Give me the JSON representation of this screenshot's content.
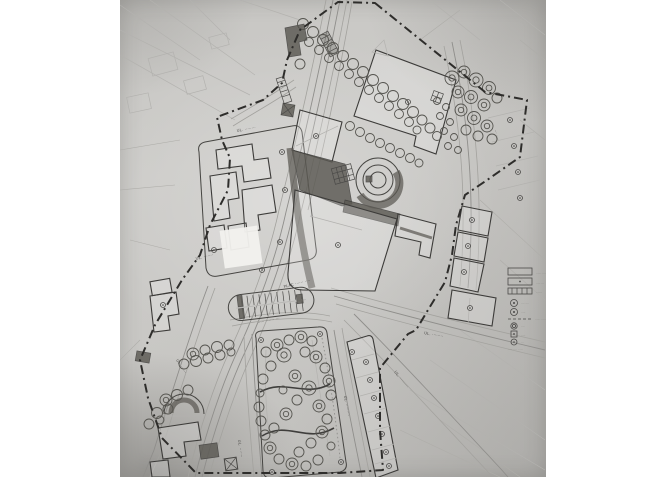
{
  "photo": {
    "description": "Black-and-white photograph of a hand-drawn urban development site plan (city centre masterplan) with dashed site boundary, streets, building footprints, a circular pavilion, parking bay, tree-lined avenue and a park",
    "paper_color": "#c9c8c5",
    "ink_color": "#3a3a38",
    "dark_fill": "#5b5953",
    "boundary_style": "dash-dot"
  },
  "map_labels": [
    {
      "id": "street-nw",
      "text": "UL. ········"
    },
    {
      "id": "street-w",
      "text": "UL. ·······"
    },
    {
      "id": "square",
      "text": "PLAC ······ ····"
    },
    {
      "id": "parking-note",
      "text": "····· ······ ···"
    },
    {
      "id": "street-e",
      "text": "UL. ········"
    },
    {
      "id": "street-se",
      "text": "UL. ·········"
    },
    {
      "id": "street-sw",
      "text": "UL. ······"
    },
    {
      "id": "street-park-w",
      "text": "UL. ·······"
    },
    {
      "id": "street-park-e",
      "text": "UL. ·········"
    },
    {
      "id": "street-ne",
      "text": "··· ····"
    }
  ],
  "legend": {
    "items": [
      {
        "symbol": "rect-outline",
        "label": "······ ·····"
      },
      {
        "symbol": "rect-dot",
        "label": "····· ···"
      },
      {
        "symbol": "rect-hatched",
        "label": "·······"
      },
      {
        "symbol": "circle-dot",
        "label": "···· ····"
      },
      {
        "symbol": "circle-dot-bold",
        "label": "·····"
      },
      {
        "symbol": "dashed-line",
        "label": "······ ·····"
      },
      {
        "symbol": "circle-ring",
        "label": "····"
      },
      {
        "symbol": "square-dot",
        "label": "·····"
      },
      {
        "symbol": "circle-small",
        "label": "···"
      }
    ],
    "caption": "····· ···· · ····"
  },
  "map_features": {
    "trees": {
      "avenue1": [
        [
          303,
          24,
          5.5
        ],
        [
          313,
          32,
          5.5
        ],
        [
          323,
          40,
          5.5
        ],
        [
          333,
          48,
          5.5
        ],
        [
          343,
          56,
          5.5
        ],
        [
          353,
          64,
          5.5
        ],
        [
          363,
          72,
          5.5
        ],
        [
          373,
          80,
          5.5
        ],
        [
          383,
          88,
          5.5
        ],
        [
          393,
          96,
          5.5
        ],
        [
          403,
          104,
          5.5
        ],
        [
          413,
          112,
          5.5
        ],
        [
          422,
          120,
          5
        ],
        [
          430,
          128,
          5
        ],
        [
          437,
          136,
          4.5
        ]
      ],
      "avenue2": [
        [
          309,
          42,
          4.5
        ],
        [
          319,
          50,
          4.5
        ],
        [
          329,
          58,
          4.5
        ],
        [
          339,
          66,
          4.5
        ],
        [
          349,
          74,
          4.5
        ],
        [
          359,
          82,
          4.5
        ],
        [
          369,
          90,
          4.5
        ],
        [
          379,
          98,
          4.5
        ],
        [
          389,
          106,
          4.5
        ],
        [
          399,
          114,
          4.5
        ],
        [
          409,
          122,
          4.5
        ],
        [
          417,
          130,
          4
        ]
      ],
      "plazarow": [
        [
          350,
          126,
          4.5
        ],
        [
          360,
          132,
          4.5
        ],
        [
          370,
          138,
          4.5
        ],
        [
          380,
          143,
          4.5
        ],
        [
          390,
          148,
          4.5
        ],
        [
          400,
          153,
          4.5
        ],
        [
          410,
          158,
          4.5
        ],
        [
          419,
          163,
          4
        ]
      ],
      "negrove": [
        [
          452,
          78,
          7
        ],
        [
          464,
          72,
          6
        ],
        [
          476,
          80,
          7
        ],
        [
          489,
          88,
          6.5
        ],
        [
          458,
          92,
          6
        ],
        [
          471,
          97,
          6.5
        ],
        [
          484,
          105,
          6
        ],
        [
          461,
          110,
          6
        ],
        [
          474,
          118,
          6.5
        ],
        [
          487,
          126,
          6
        ],
        [
          466,
          130,
          5
        ],
        [
          497,
          98,
          5
        ],
        [
          492,
          139,
          5
        ],
        [
          478,
          136,
          5
        ]
      ],
      "courtyard": [
        [
          437,
          101,
          3.5
        ],
        [
          446,
          107,
          3.5
        ],
        [
          440,
          116,
          3.5
        ],
        [
          450,
          122,
          3.5
        ],
        [
          444,
          131,
          3.5
        ],
        [
          454,
          137,
          3.5
        ],
        [
          448,
          146,
          3.5
        ],
        [
          458,
          150,
          3.5
        ]
      ],
      "park": [
        [
          266,
          352,
          5
        ],
        [
          277,
          345,
          6
        ],
        [
          289,
          340,
          5
        ],
        [
          301,
          337,
          6
        ],
        [
          312,
          341,
          5
        ],
        [
          284,
          355,
          7
        ],
        [
          271,
          366,
          5
        ],
        [
          263,
          379,
          5
        ],
        [
          260,
          393,
          4
        ],
        [
          259,
          407,
          5
        ],
        [
          261,
          421,
          5
        ],
        [
          265,
          435,
          5
        ],
        [
          270,
          448,
          6
        ],
        [
          279,
          459,
          5
        ],
        [
          292,
          464,
          6
        ],
        [
          306,
          466,
          5
        ],
        [
          318,
          460,
          5
        ],
        [
          305,
          352,
          5
        ],
        [
          316,
          357,
          6
        ],
        [
          325,
          368,
          5
        ],
        [
          329,
          381,
          6
        ],
        [
          331,
          395,
          5
        ],
        [
          309,
          388,
          7
        ],
        [
          297,
          400,
          5
        ],
        [
          319,
          406,
          6
        ],
        [
          327,
          419,
          5
        ],
        [
          322,
          432,
          6
        ],
        [
          311,
          443,
          5
        ],
        [
          299,
          452,
          5
        ],
        [
          331,
          446,
          4
        ],
        [
          286,
          414,
          6
        ],
        [
          274,
          428,
          5
        ],
        [
          295,
          376,
          6
        ],
        [
          283,
          390,
          4
        ]
      ],
      "westgrove": [
        [
          193,
          354,
          6
        ],
        [
          205,
          350,
          5
        ],
        [
          217,
          347,
          5.5
        ],
        [
          229,
          345,
          5
        ],
        [
          184,
          364,
          5
        ],
        [
          196,
          361,
          5.5
        ],
        [
          208,
          358,
          5
        ],
        [
          220,
          355,
          5
        ],
        [
          231,
          352,
          4
        ],
        [
          166,
          400,
          6
        ],
        [
          177,
          395,
          5.5
        ],
        [
          188,
          390,
          5
        ],
        [
          157,
          413,
          5.5
        ],
        [
          168,
          409,
          5
        ],
        [
          149,
          424,
          5
        ],
        [
          160,
          420,
          4
        ],
        [
          300,
          64,
          5
        ]
      ]
    },
    "markers": [
      [
        282,
        152
      ],
      [
        285,
        190
      ],
      [
        280,
        242
      ],
      [
        214,
        250
      ],
      [
        262,
        270
      ],
      [
        408,
        102
      ],
      [
        316,
        136
      ],
      [
        338,
        245
      ],
      [
        472,
        220
      ],
      [
        468,
        246
      ],
      [
        464,
        272
      ],
      [
        470,
        308
      ],
      [
        163,
        305
      ],
      [
        366,
        362
      ],
      [
        370,
        380
      ],
      [
        374,
        398
      ],
      [
        378,
        416
      ],
      [
        382,
        434
      ],
      [
        386,
        452
      ],
      [
        389,
        466
      ],
      [
        510,
        120
      ],
      [
        514,
        146
      ],
      [
        518,
        172
      ],
      [
        520,
        198
      ],
      [
        261,
        340
      ],
      [
        320,
        334
      ],
      [
        341,
        462
      ],
      [
        272,
        472
      ],
      [
        352,
        352
      ]
    ]
  }
}
